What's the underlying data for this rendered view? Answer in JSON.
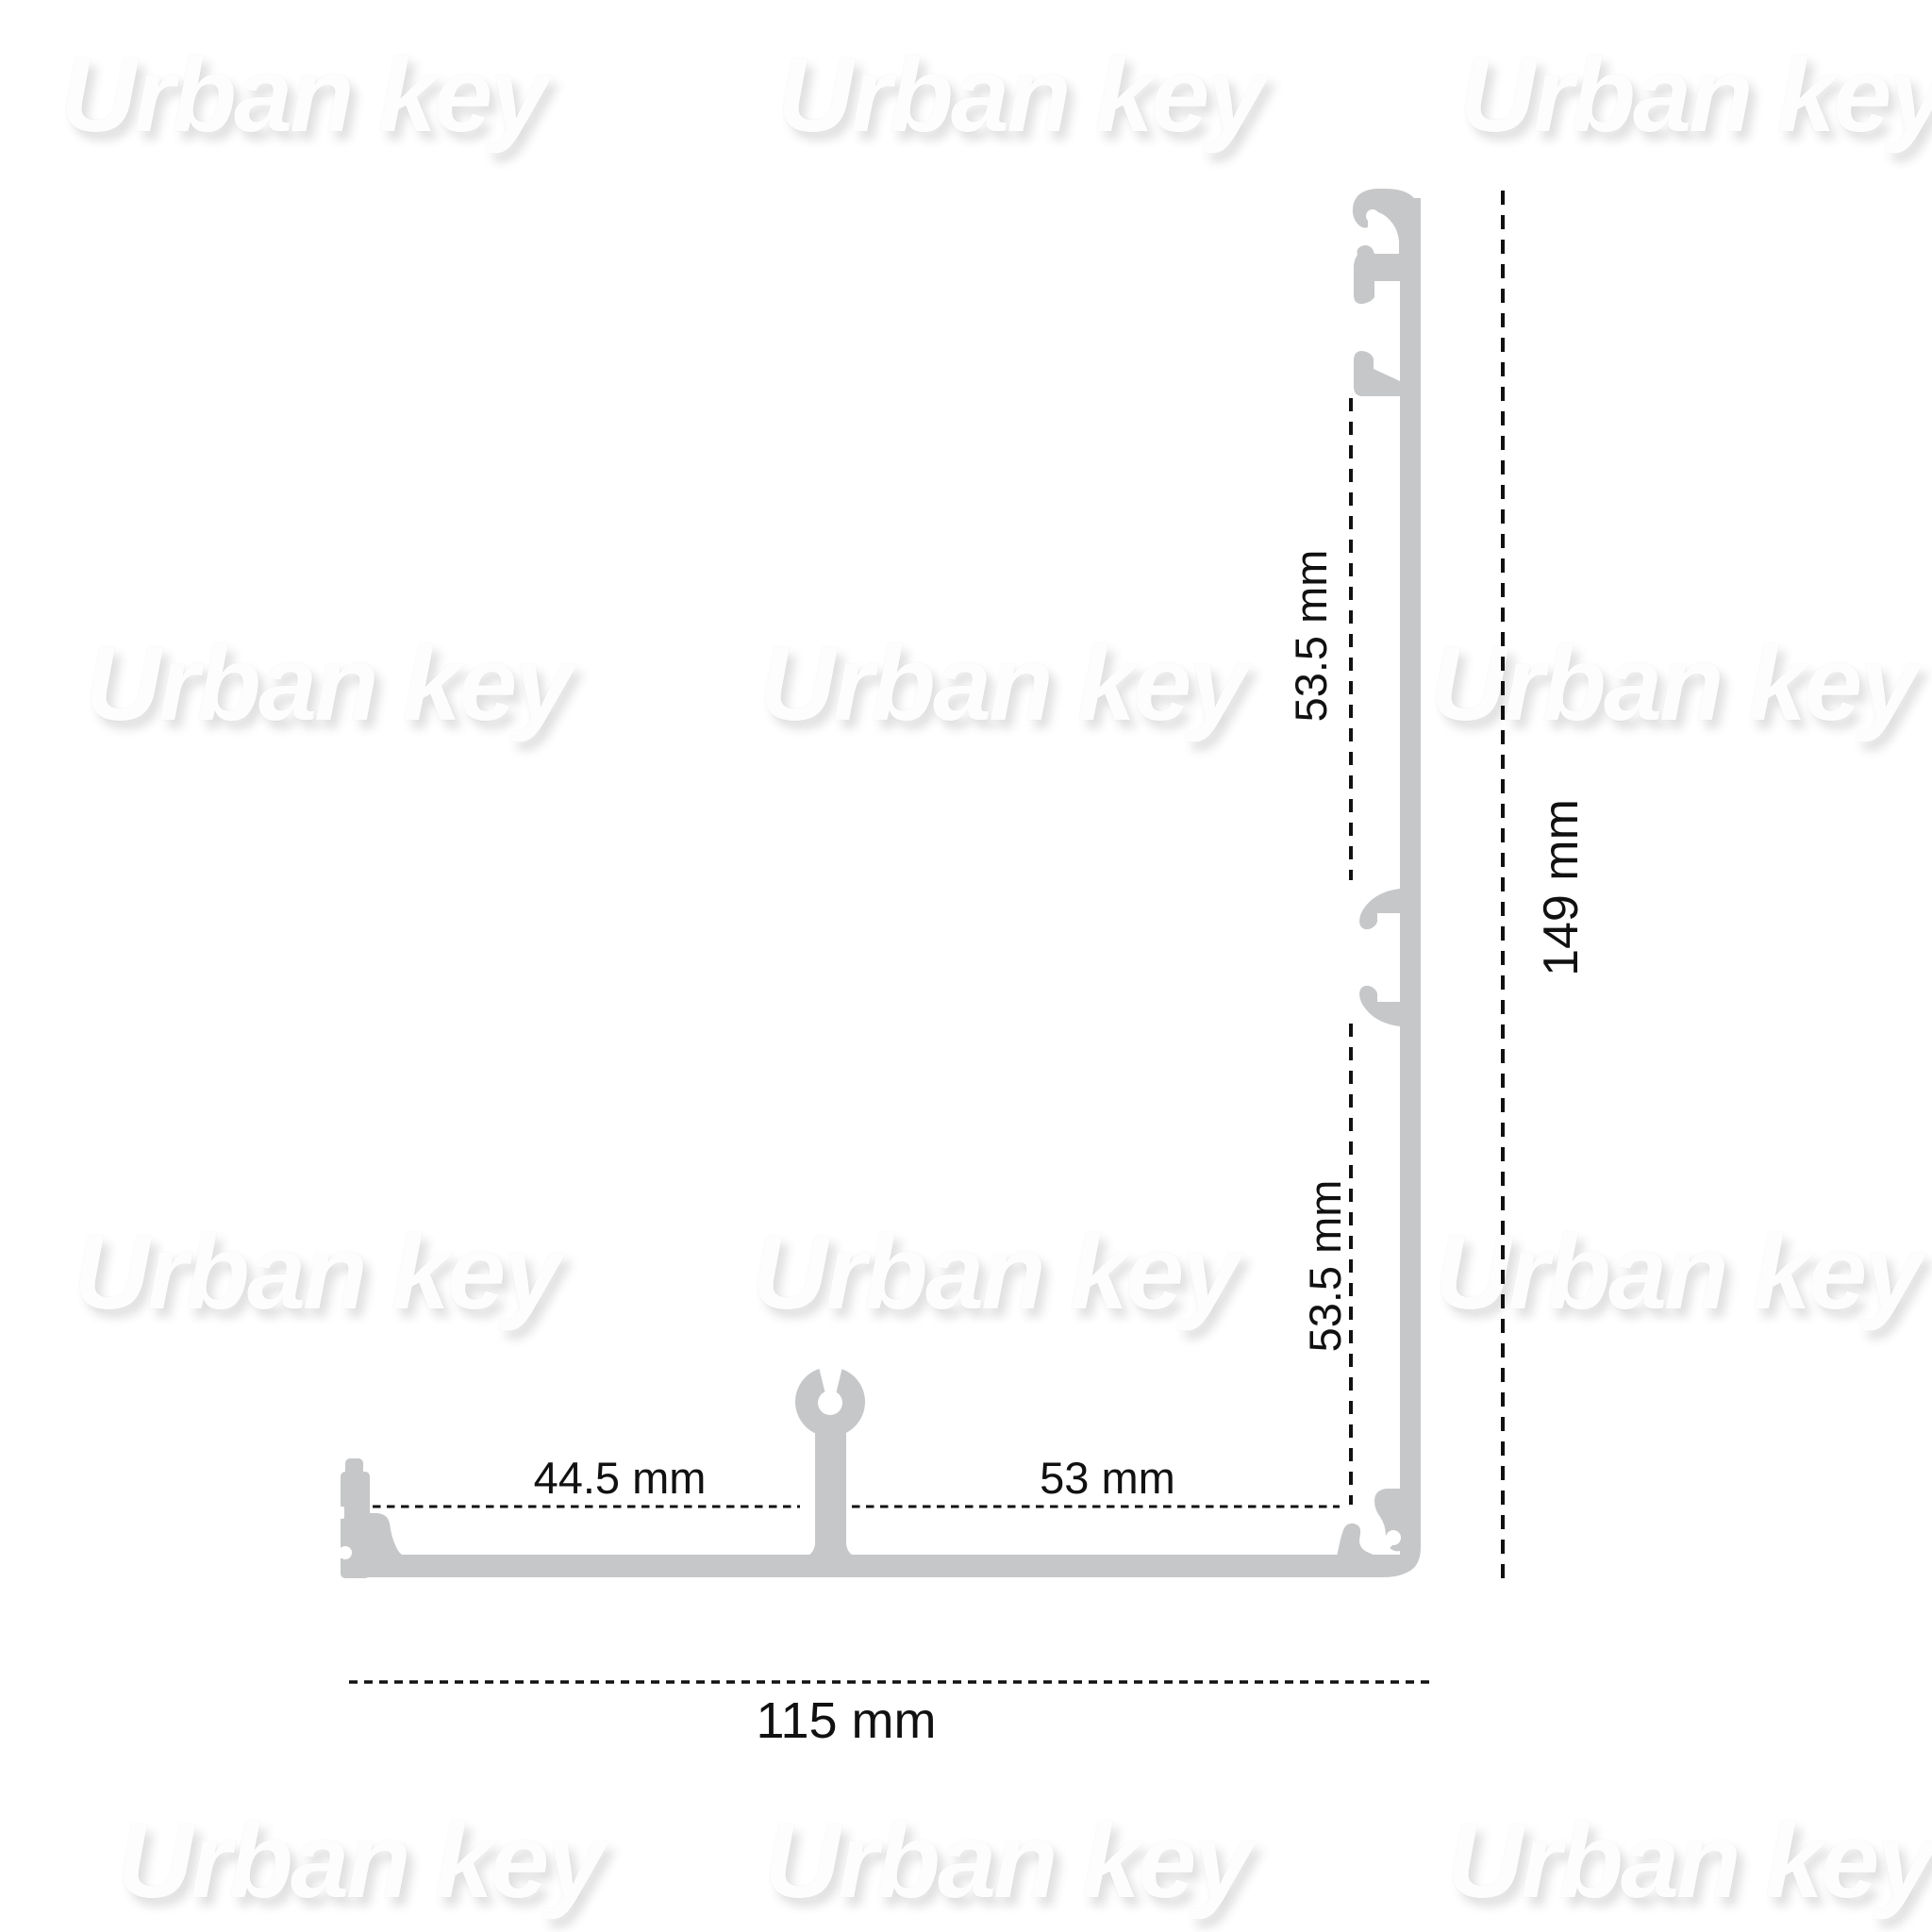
{
  "watermark": {
    "text": "Urban key"
  },
  "labels": {
    "height_total": "149 mm",
    "width_total": "115 mm",
    "seg_upper": "53.5 mm",
    "seg_lower": "53.5 mm",
    "seg_left": "44.5 mm",
    "seg_right": "53 mm"
  },
  "colors": {
    "profile": "#c6c7c9",
    "dimension": "#111111",
    "watermark": "#fdfdfd"
  }
}
